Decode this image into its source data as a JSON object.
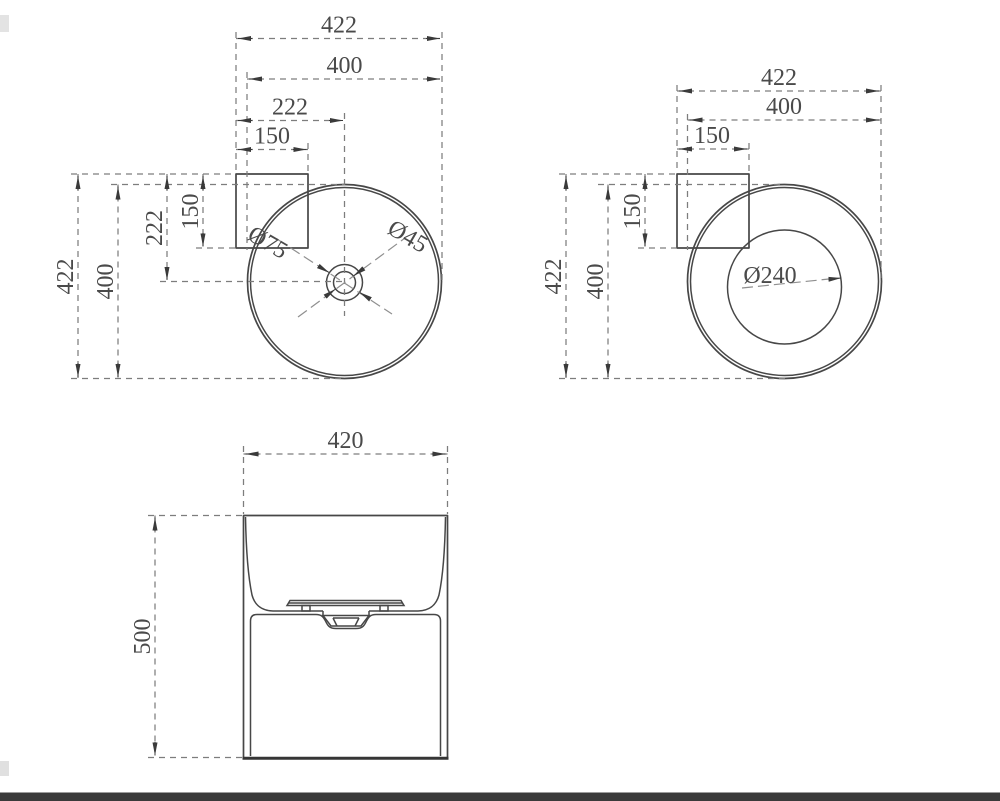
{
  "page": {
    "background": "#ffffff",
    "footer_bar_color": "#3a3a3a",
    "line_color": "#474747",
    "dim_line_color": "#7d7d7d",
    "text_color": "#4a4a4a"
  },
  "views": {
    "top_left": {
      "h": {
        "overall": "422",
        "rim": "400",
        "center": "222",
        "tab": "150"
      },
      "v": {
        "overall": "422",
        "rim": "400",
        "center": "222",
        "tab": "150"
      },
      "dia": {
        "hole_outer": "Ø75",
        "hole_inner": "Ø45"
      }
    },
    "top_right": {
      "h": {
        "overall": "422",
        "rim": "400",
        "tab": "150"
      },
      "v": {
        "overall": "422",
        "rim": "400",
        "tab": "150"
      },
      "dia": {
        "bowl": "Ø240"
      }
    },
    "front": {
      "width": "420",
      "height": "500"
    }
  }
}
